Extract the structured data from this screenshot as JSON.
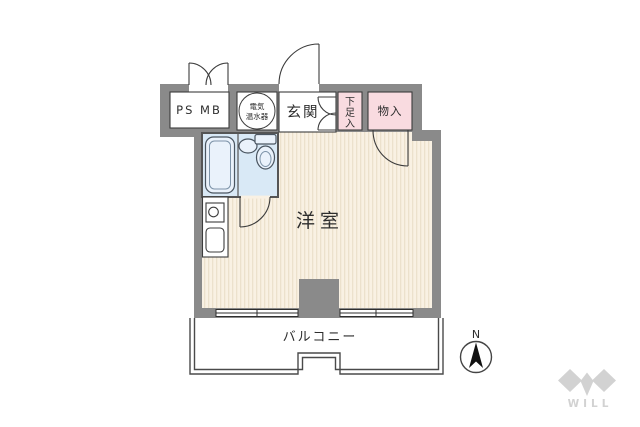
{
  "plan": {
    "labels": {
      "ps_mb": "PS MB",
      "water_heater_line1": "電気",
      "water_heater_line2": "温水器",
      "entrance": "玄関",
      "shoe_storage_chars": [
        "下",
        "足",
        "入"
      ],
      "storage": "物入",
      "main_room": "洋室",
      "balcony": "バルコニー",
      "compass_north": "N",
      "brand": "WILL"
    },
    "colors": {
      "wall": "#8a8a8a",
      "floor_base": "#f9f1e3",
      "floor_stripe": "#ece1cc",
      "closet_pink": "#f9dbe0",
      "bath_blue": "#d9e9f6",
      "fixture_fill": "#eaf2fb",
      "logo_gray": "#d2d2d2"
    }
  }
}
